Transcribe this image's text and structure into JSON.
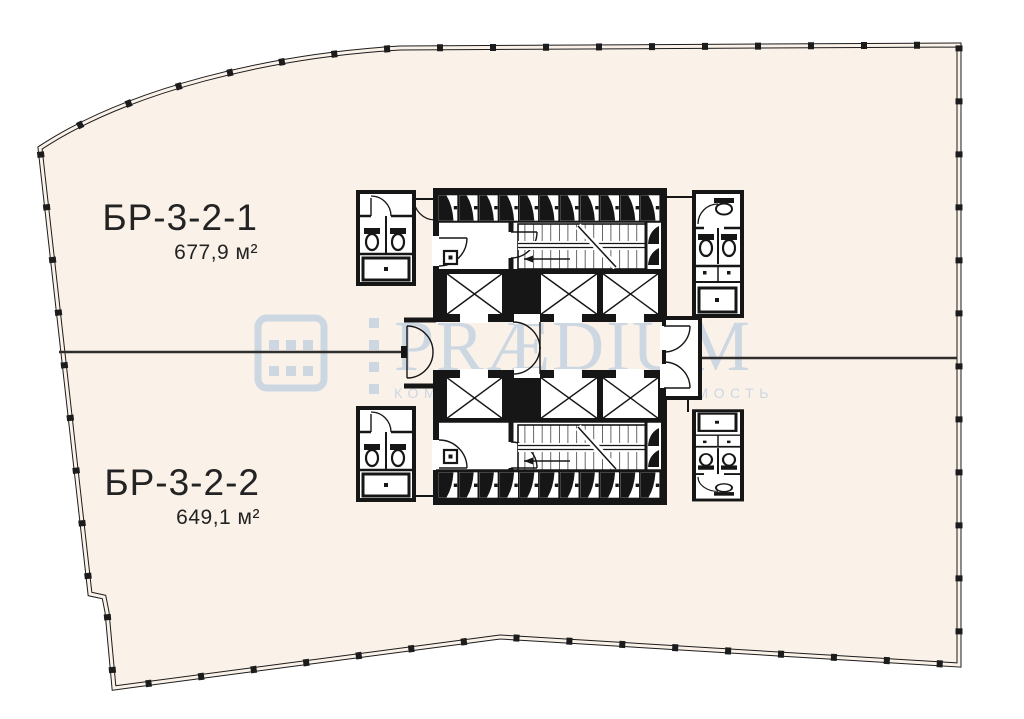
{
  "floorplan": {
    "units": [
      {
        "name": "БР-3-2-1",
        "area": "677,9 м²"
      },
      {
        "name": "БР-3-2-2",
        "area": "649,1 м²"
      }
    ],
    "colors": {
      "floor_fill": "#faf1e9",
      "walls": "#161616",
      "divider_line": "#2e2e2e",
      "watermark": "#ccd7e2"
    },
    "symbols": {
      "elevator": "crossed-box-elevator-shaft",
      "staircase": "stair-run-with-treads",
      "restroom": "wc-pod-with-toilets-and-counter",
      "vent_shaft": "hatched-shaft-cell"
    }
  },
  "watermark": {
    "brand": "PRÆDIUM",
    "tagline": "КОММЕРЧЕСКАЯ НЕДВИЖИМОСТЬ",
    "logo": "building-window-grid"
  }
}
